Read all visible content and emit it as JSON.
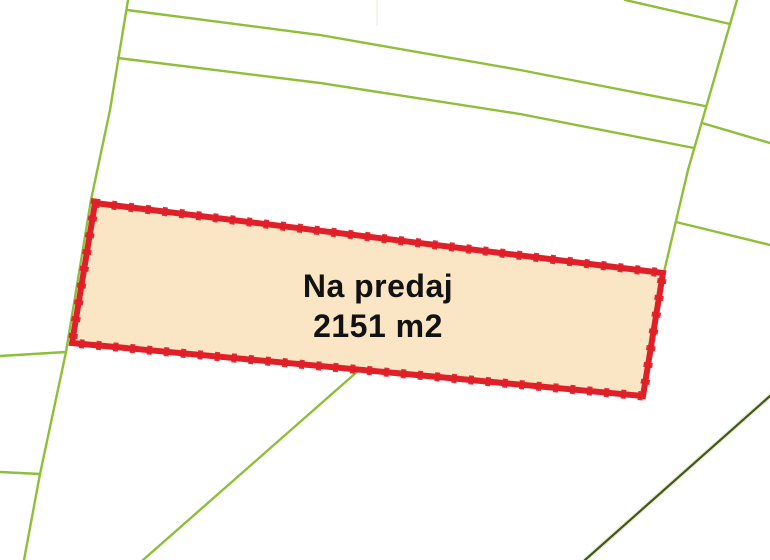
{
  "window": {
    "width_px": 770,
    "height_px": 560
  },
  "map": {
    "type": "cadastral-parcel-map",
    "background_color": "#FFFFFF",
    "label": {
      "line1": "Na predaj",
      "line2": "2151 m2",
      "area_m2": 2151,
      "text_color": "#121212"
    },
    "colors": {
      "parcel_fill": "#FAE5C4",
      "parcel_border": "#E02028",
      "boundary_green": "#8FBE38",
      "boundary_dark_green": "#42551B",
      "boundary_dark_halo": "#C9D795",
      "artifact_gray": "#EEF0E8"
    },
    "parcel": {
      "points": "95,203 663,273 643,396 72,343"
    },
    "boundaries": [
      {
        "name": "left-steep-boundary",
        "points": "128,0 110,110 91,200 66,352 40,474 24,560"
      },
      {
        "name": "upper-boundary-1",
        "points": "127,10 320,35 520,70 705,106"
      },
      {
        "name": "upper-boundary-2",
        "points": "118,58 320,83 520,114 694,148"
      },
      {
        "name": "right-steep-boundary",
        "points": "737,0 688,170 664,272"
      },
      {
        "name": "top-right-boundary",
        "points": "625,0 730,24"
      },
      {
        "name": "right-branch-upper",
        "points": "702,123 770,143"
      },
      {
        "name": "right-branch-lower",
        "points": "676,222 770,245"
      },
      {
        "name": "left-stub-upper",
        "points": "0,356 66,352"
      },
      {
        "name": "left-stub-lower",
        "points": "0,472 40,474"
      },
      {
        "name": "lower-diagonal-boundary",
        "points": "358,371 143,560"
      }
    ],
    "dark_boundary": {
      "name": "dark-diagonal-boundary",
      "points": "770,396 585,560"
    },
    "artifact_line": {
      "points": "377,0 377,26"
    }
  }
}
